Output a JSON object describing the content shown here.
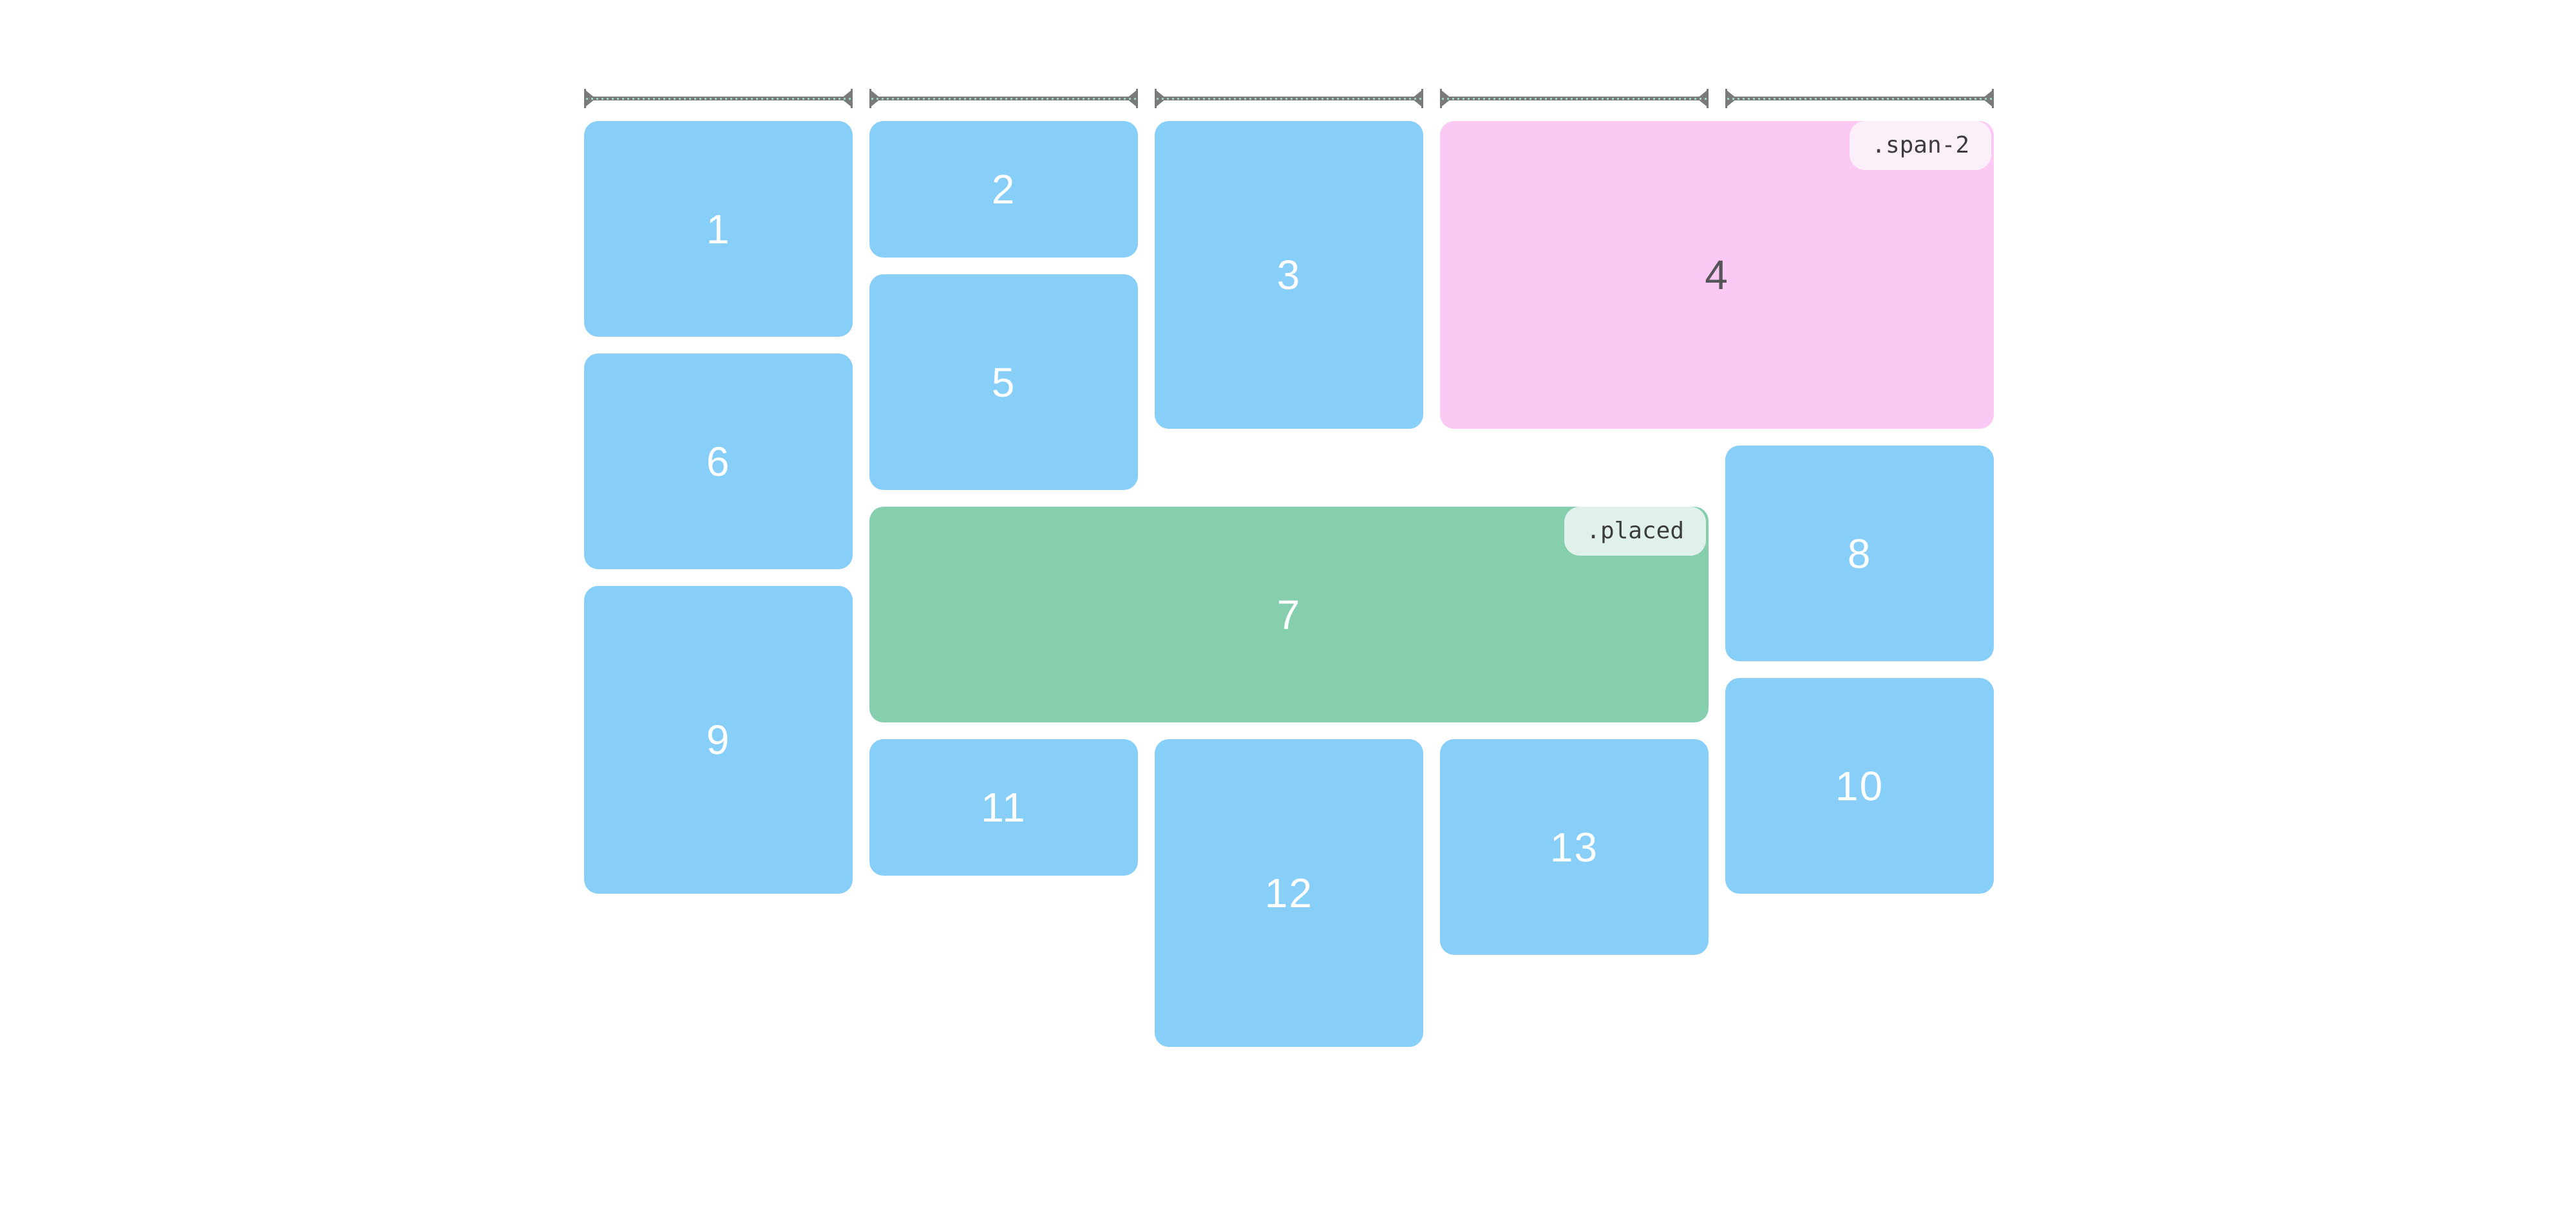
{
  "page": {
    "background": "#ffffff",
    "description_visible_text_only": ""
  },
  "colors": {
    "item_blue": "#87cef9",
    "item_pink": "#fcc9f4",
    "item_green": "#85cfaf",
    "badge_span2_bg": "#fbeff9",
    "badge_placed_bg": "#e0f0ea",
    "badge_text": "#3c3c3c",
    "number_light": "#ffffff",
    "number_dark": "#56565a",
    "ruler_gray": "#7a7a7a",
    "ruler_dots_mint": "#9ed4be"
  },
  "grid": {
    "column_count": 5,
    "ruler_count": 5
  },
  "blocks": [
    {
      "label": "1",
      "color": "blue"
    },
    {
      "label": "2",
      "color": "blue"
    },
    {
      "label": "3",
      "color": "blue"
    },
    {
      "label": "4",
      "color": "pink",
      "badge": ".span-2"
    },
    {
      "label": "5",
      "color": "blue"
    },
    {
      "label": "6",
      "color": "blue"
    },
    {
      "label": "7",
      "color": "green",
      "badge": ".placed"
    },
    {
      "label": "8",
      "color": "blue"
    },
    {
      "label": "9",
      "color": "blue"
    },
    {
      "label": "10",
      "color": "blue"
    },
    {
      "label": "11",
      "color": "blue"
    },
    {
      "label": "12",
      "color": "blue"
    },
    {
      "label": "13",
      "color": "blue"
    }
  ]
}
